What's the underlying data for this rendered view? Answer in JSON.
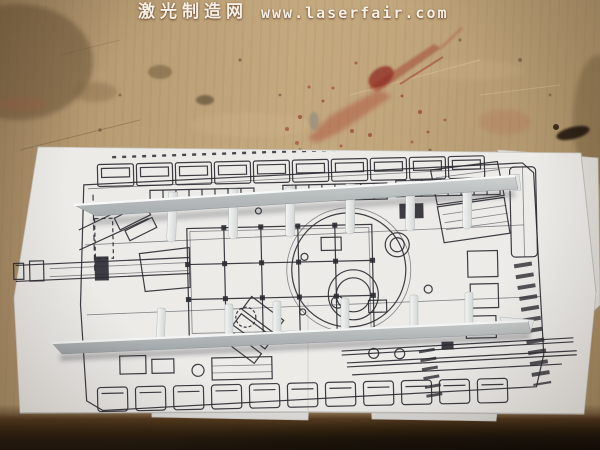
{
  "watermark": {
    "site_name": "激光制造网",
    "site_url": "www.laserfair.com"
  },
  "colors": {
    "wood": "#bda27a",
    "wood-dark": "#8a7152",
    "wood-edge": "#2e2012",
    "paper": "#ecebe8",
    "ink": "#2c2c33",
    "part-white": "#eef1f0",
    "part-gray": "#b3b8ba",
    "stain-red": "#9e2f23",
    "watermark-text": "#f6f1e7"
  }
}
